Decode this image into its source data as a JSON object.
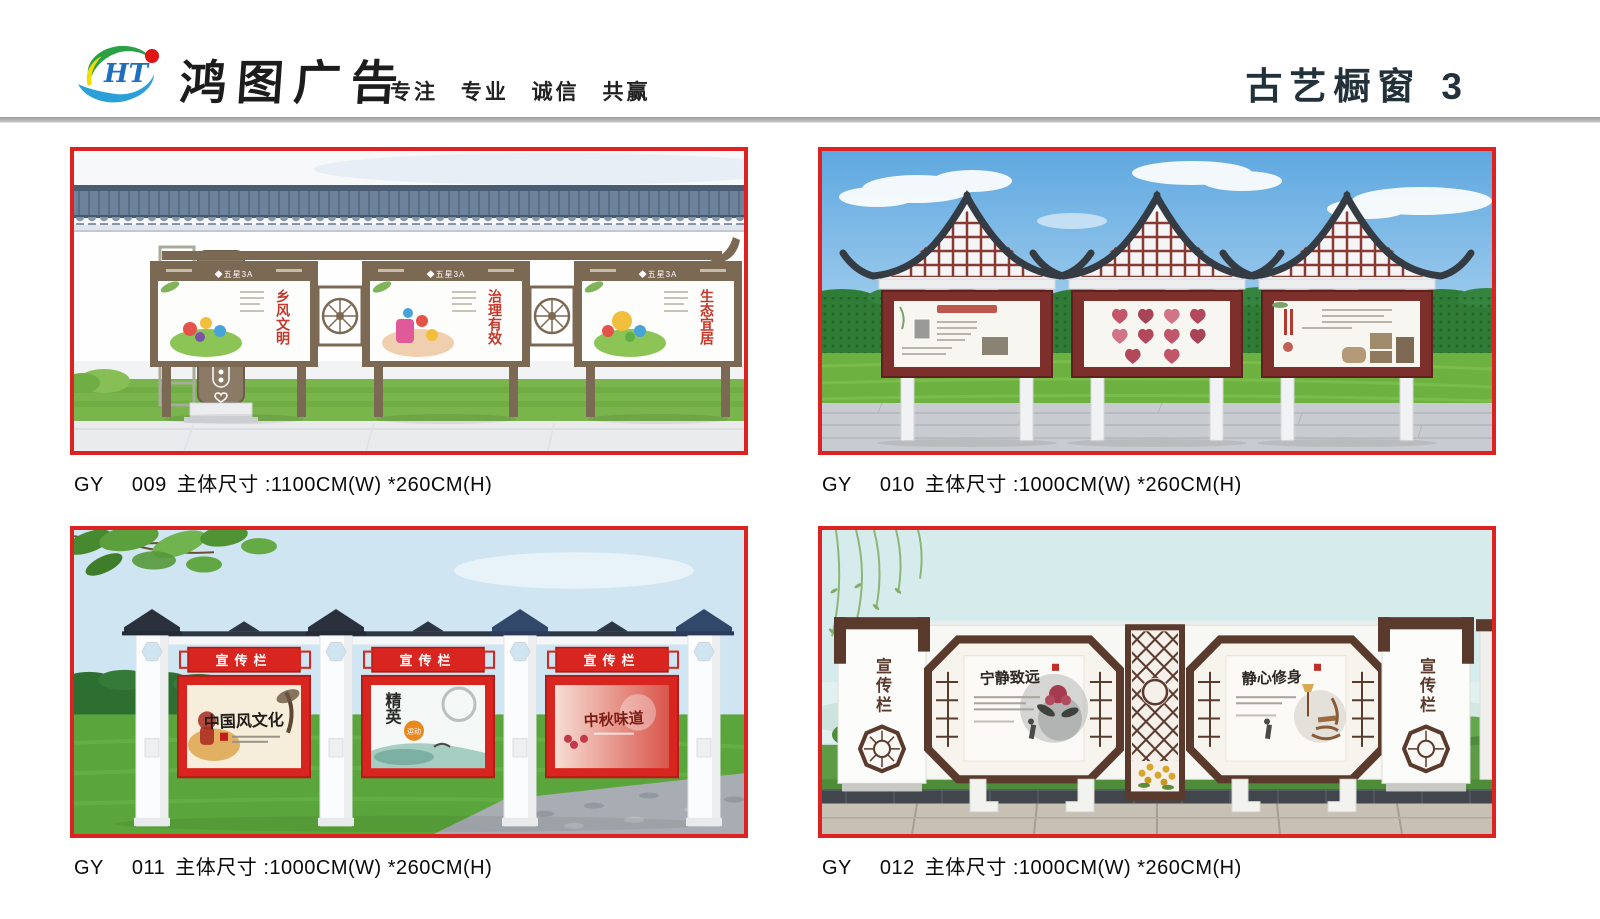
{
  "header": {
    "brand": "鸿图广告",
    "slogan": "专注 专业 诚信 共赢",
    "section_title": "古艺橱窗",
    "page_number": "3",
    "logo": {
      "monogram": "HT"
    }
  },
  "colors": {
    "accent_red": "#dd2222",
    "divider_gray": "#ababab"
  },
  "products": [
    {
      "series": "GY",
      "code": "009",
      "size": "主体尺寸 :1100CM(W) *260CM(H)"
    },
    {
      "series": "GY",
      "code": "010",
      "size": "主体尺寸 :1000CM(W) *260CM(H)"
    },
    {
      "series": "GY",
      "code": "011",
      "size": "主体尺寸 :1000CM(W) *260CM(H)"
    },
    {
      "series": "GY",
      "code": "012",
      "size": "主体尺寸 :1000CM(W) *260CM(H)"
    }
  ],
  "scenes": {
    "gy009": {
      "sign_title": "文化",
      "board_header": "◆五星3A",
      "poster_titles": [
        "乡风文明",
        "治理有效",
        "生态宜居"
      ]
    },
    "gy011": {
      "plate_title": "宣传栏",
      "poster1_title": "中国风文化",
      "poster2_title": "精英",
      "poster2_badge": "运动",
      "poster3_title": "中秋味道"
    },
    "gy012": {
      "side_label": "宣传栏",
      "poster1_title": "宁静致远",
      "poster2_title": "静心修身"
    }
  }
}
